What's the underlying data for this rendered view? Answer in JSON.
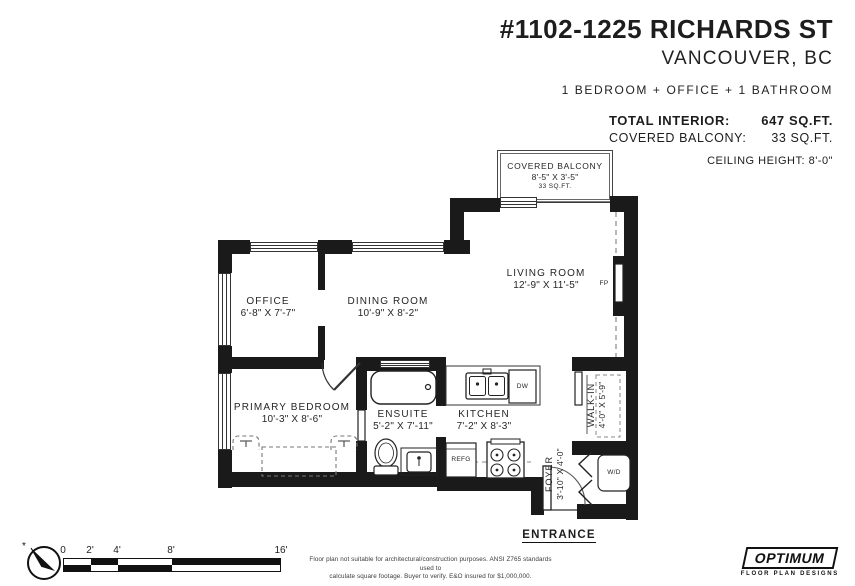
{
  "header": {
    "title": "#1102-1225 RICHARDS ST",
    "city": "VANCOUVER, BC",
    "summary": "1 BEDROOM + OFFICE + 1 BATHROOM",
    "total_interior_label": "TOTAL INTERIOR:",
    "total_interior_value": "647 SQ.FT.",
    "covered_balcony_label": "COVERED BALCONY:",
    "covered_balcony_value": "33 SQ.FT.",
    "ceiling_height": "CEILING HEIGHT: 8'-0\""
  },
  "rooms": {
    "covered_balcony": {
      "name": "COVERED BALCONY",
      "dims": "8'-5\" X 3'-5\"",
      "area": "33 SQ.FT."
    },
    "living_room": {
      "name": "LIVING ROOM",
      "dims": "12'-9\" X 11'-5\""
    },
    "dining_room": {
      "name": "DINING ROOM",
      "dims": "10'-9\" X 8'-2\""
    },
    "office": {
      "name": "OFFICE",
      "dims": "6'-8\" X 7'-7\""
    },
    "primary_bedroom": {
      "name": "PRIMARY BEDROOM",
      "dims": "10'-3\" X 8'-6\""
    },
    "ensuite": {
      "name": "ENSUITE",
      "dims": "5'-2\" X 7'-11\""
    },
    "kitchen": {
      "name": "KITCHEN",
      "dims": "7'-2\" X 8'-3\""
    },
    "walk_in": {
      "name": "WALK-IN",
      "dims": "4'-0\" X 5'-9\""
    },
    "foyer": {
      "name": "FOYER",
      "dims": "3'-10\" X 4'-0\""
    }
  },
  "fixtures": {
    "fireplace": "FP",
    "dishwasher": "DW",
    "fridge": "REFG",
    "washer_dryer": "W/D"
  },
  "entrance_label": "ENTRANCE",
  "scale_bar": {
    "labels": [
      "0",
      "2'",
      "4'",
      "8'",
      "16'"
    ]
  },
  "footer": {
    "disclaimer_line1": "Floor plan not suitable for architectural/construction purposes. ANSI Z765 standards used to",
    "disclaimer_line2": "calculate square footage. Buyer to verify.  E&O insured for $1,000,000.",
    "logo_name": "OPTIMUM",
    "logo_tagline": "FLOOR PLAN DESIGNS"
  },
  "colors": {
    "wall": "#1a1a1a",
    "text": "#1d1d1d"
  }
}
